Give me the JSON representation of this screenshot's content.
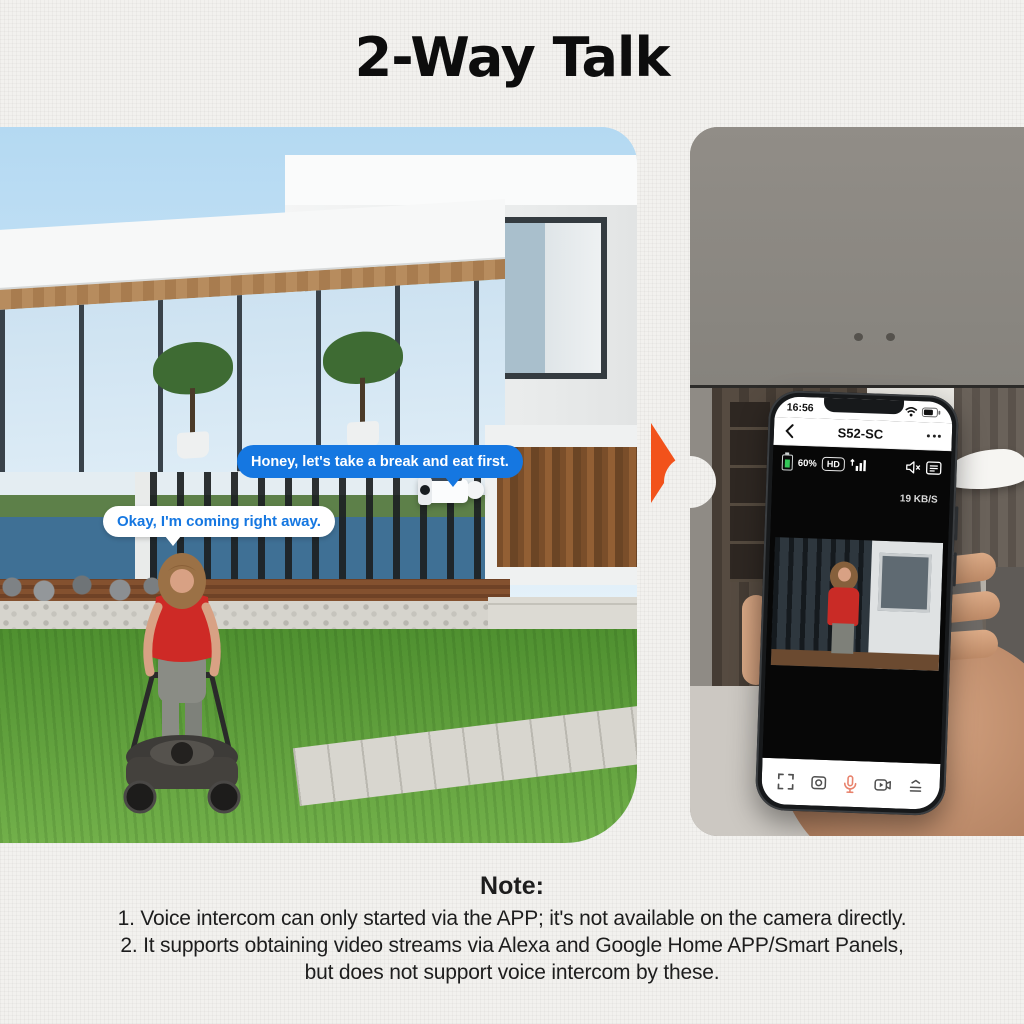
{
  "page": {
    "title": "2-Way Talk"
  },
  "colors": {
    "accent_blue": "#1577e1",
    "arrow_orange": "#f2521b",
    "mic_coral": "#e8826c",
    "battery_green": "#34c759"
  },
  "scene_left": {
    "bubble_camera_text": "Honey, let's take a break and eat first.",
    "bubble_person_text": "Okay, I'm coming right away."
  },
  "phone": {
    "status_bar": {
      "time": "16:56"
    },
    "nav": {
      "title": "S52-SC"
    },
    "video_hud": {
      "battery": "60%",
      "quality": "HD",
      "bitrate": "19 KB/S"
    }
  },
  "note": {
    "heading": "Note:",
    "lines": [
      "1. Voice intercom can only started via the APP; it's not available on the camera directly.",
      "2. It supports obtaining video streams via Alexa and Google Home APP/Smart Panels,",
      "but does not support voice intercom by these."
    ]
  }
}
